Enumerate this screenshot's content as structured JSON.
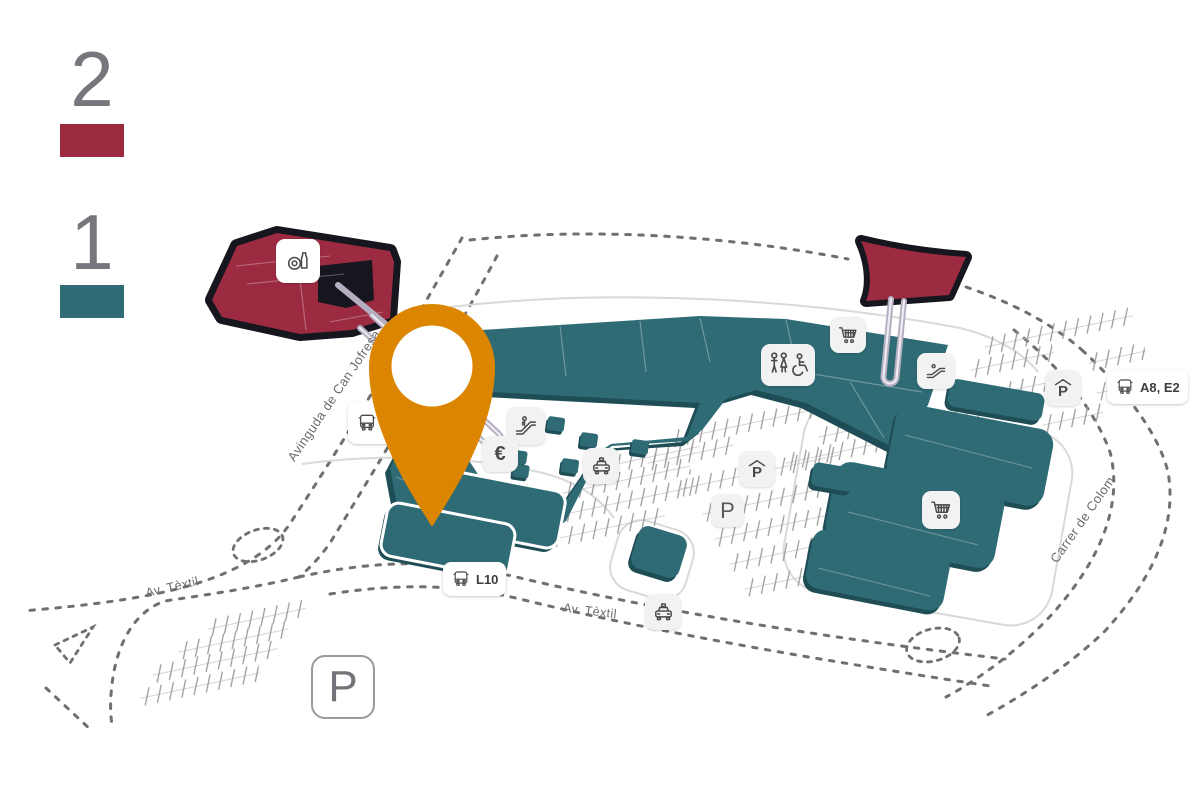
{
  "legend": {
    "floor_2_label": "2",
    "floor_1_label": "1"
  },
  "streets": {
    "avinguda_can_jofresa": "Avinguda de Can Jofresa",
    "carrer_de_colom": "Carrer de Colom",
    "av_textil_west": "Av. Tèxtil",
    "av_textil_south": "Av. Tèxtil"
  },
  "transit": {
    "bus_west_line1": "L7,",
    "bus_west_line2": "BUS",
    "bus_south_label": "L10",
    "bus_east_label": "A8, E2"
  },
  "parking": {
    "covered_label": "P",
    "surface_label": "P",
    "main_lot_label": "P"
  },
  "services": {
    "atm_label": "€"
  },
  "icons": {
    "location_pin": "location-pin",
    "bus": "bus-icon",
    "taxi": "taxi-icon",
    "shopping_cart": "shopping-cart-icon",
    "escalator": "escalator-icon",
    "restroom": "restroom-icon",
    "restaurant": "restaurant-icon",
    "covered_parking": "covered-parking-icon",
    "parking": "parking-icon",
    "atm": "euro-icon"
  },
  "colors": {
    "floor_1": "#2F6B75",
    "floor_1_shadow": "#1E4D56",
    "floor_2": "#9C2B42",
    "building_base": "#15161E",
    "pin": "#DB8500",
    "road": "#707070",
    "hatch": "#9B9B9B"
  }
}
